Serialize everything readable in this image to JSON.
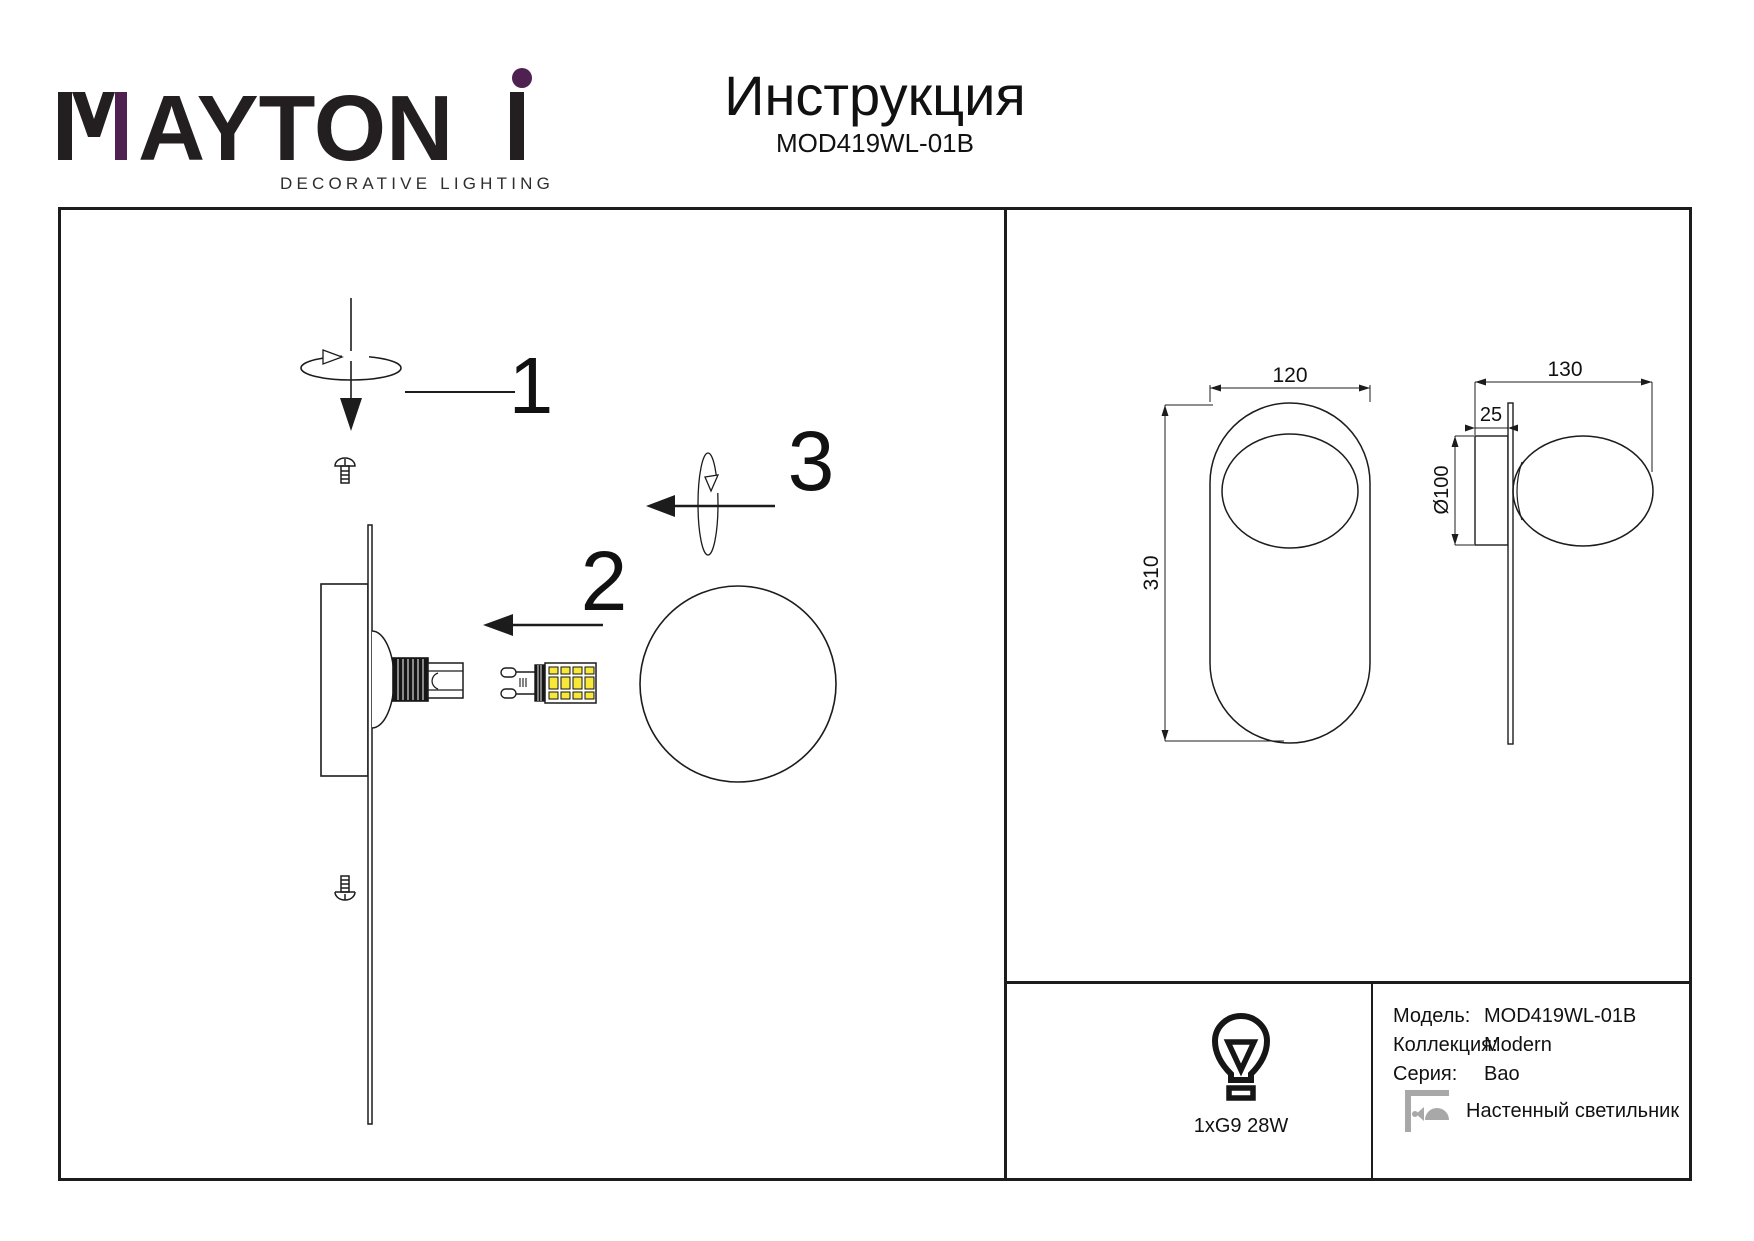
{
  "brand": {
    "name": "MAYTONI",
    "letters_mid": "AYTON",
    "tagline": "DECORATIVE LIGHTING"
  },
  "header": {
    "title": "Инструкция",
    "model": "MOD419WL-01B"
  },
  "assembly": {
    "step1": "1",
    "step2": "2",
    "step3": "3"
  },
  "dims": {
    "front_width": "120",
    "front_height": "310",
    "side_depth": "130",
    "plate_depth": "25",
    "sphere_diameter": "Ø100"
  },
  "spec": {
    "lamp_caption": "1xG9 28W",
    "model_label": "Модель:",
    "model_value": "MOD419WL-01B",
    "collection_label": "Коллекция:",
    "collection_value": "Modern",
    "series_label": "Серия:",
    "series_value": "Bao",
    "type_value": "Настенный светильник"
  },
  "colors": {
    "accent_purple": "#4f2150",
    "ink": "#231f20",
    "led_yellow": "#f7e83a",
    "icon_gray": "#a8a8a8"
  }
}
